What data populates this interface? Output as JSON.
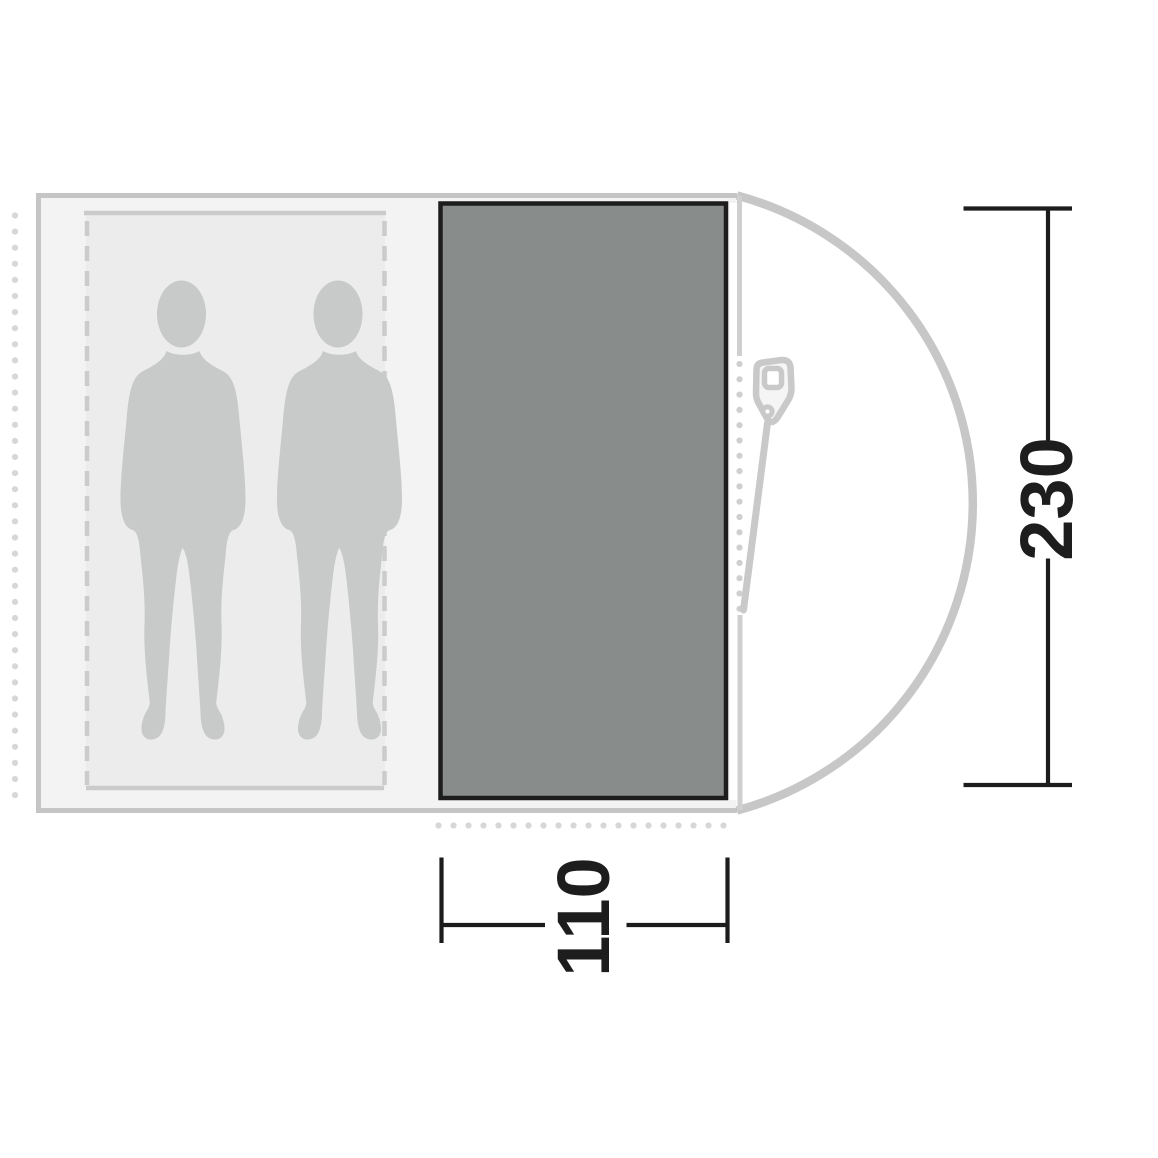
{
  "diagram": {
    "type": "tent-floorplan-top-view",
    "dimensions": {
      "height_label": "230",
      "height_value": 230,
      "width_label": "110",
      "width_value": 110
    },
    "colors": {
      "background": "#ffffff",
      "tent_body_fill": "#f3f3f3",
      "tent_border": "#c5c5c5",
      "inner_cabin_fill": "#ebeceb",
      "inner_cabin_border": "#cbcbcb",
      "groundsheet_fill": "#888c8a",
      "groundsheet_border": "#1d1d1d",
      "dome_outline": "#c7c7c7",
      "door_line": "#cfcfcf",
      "peg_dots": "#d7d7d7",
      "silhouette": "#c7cac9",
      "dimension_lines": "#1c1c1c"
    },
    "icons": {
      "zipper": "zipper-pull-icon",
      "occupants": "person-silhouette",
      "occupant_count": 2
    }
  }
}
